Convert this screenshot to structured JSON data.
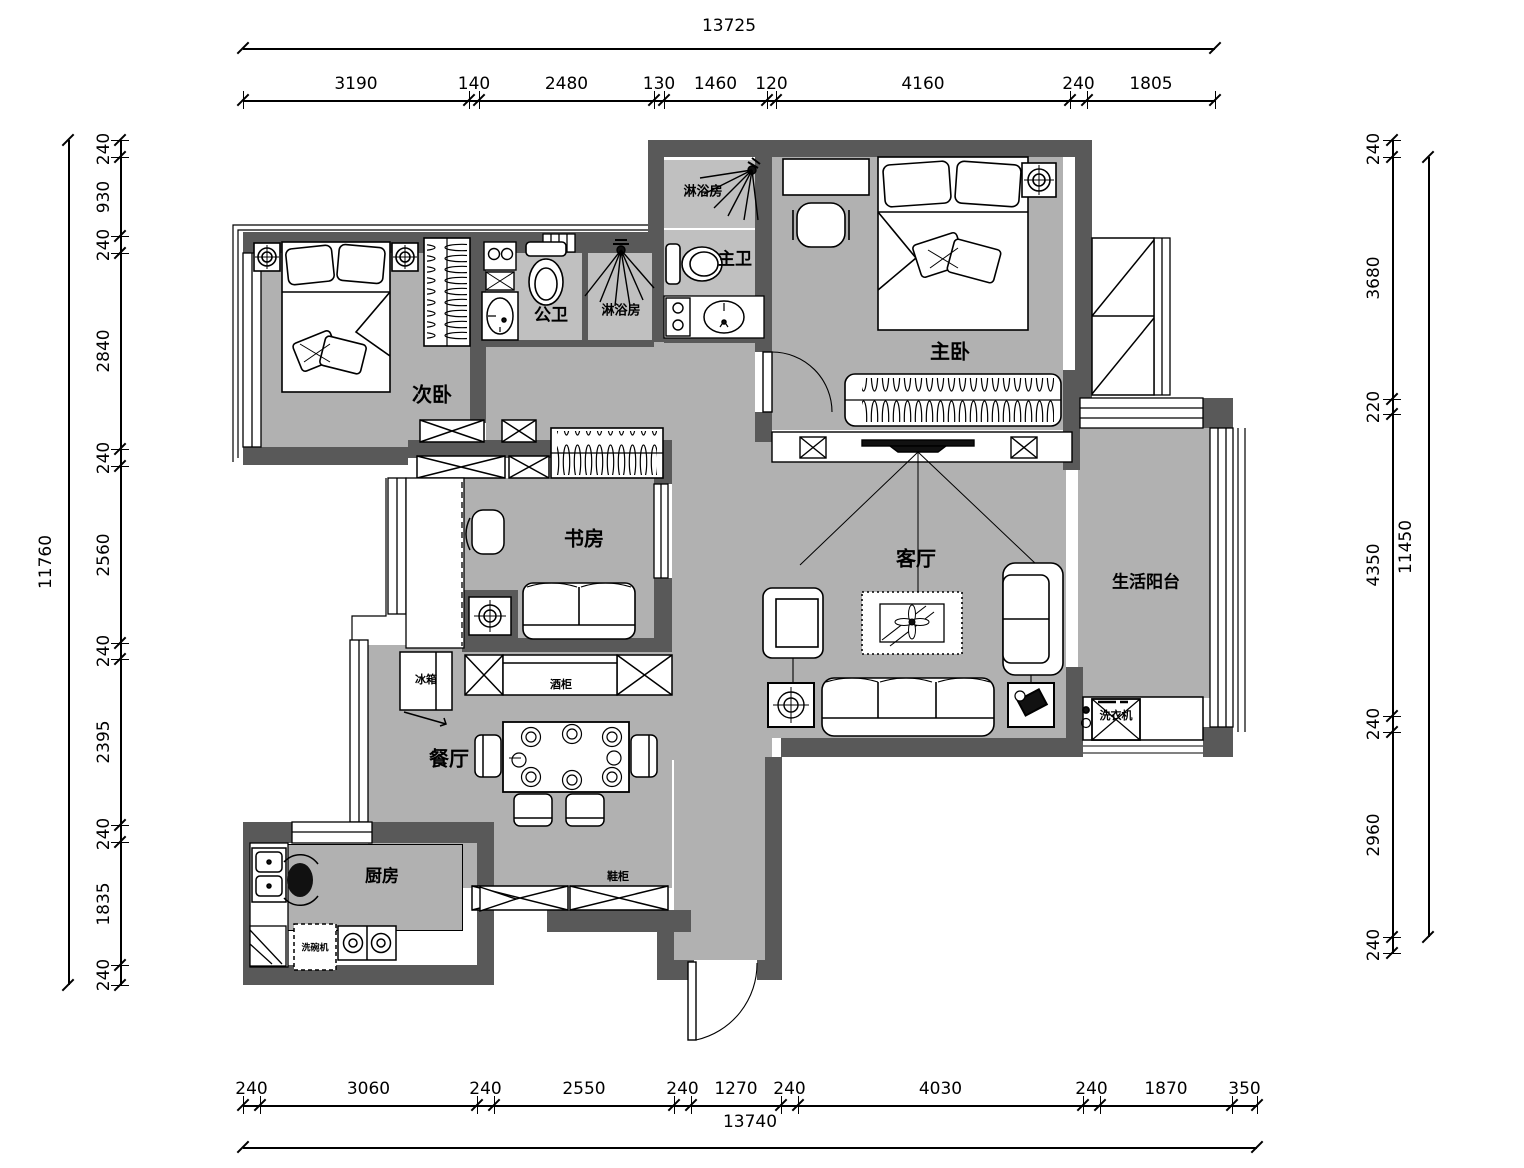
{
  "drawing": {
    "kind": "residential floor plan",
    "units": "mm"
  },
  "rooms": {
    "ciwo": "次卧",
    "gongwei": "公卫",
    "shower_a": "淋浴房",
    "shower_b": "淋浴房",
    "zhuwei": "主卫",
    "zhuwo": "主卧",
    "shufang": "书房",
    "keting": "客厅",
    "yangtai": "生活阳台",
    "canting": "餐厅",
    "chufang": "厨房"
  },
  "furniture": {
    "bingxiang": "冰箱",
    "jiugui": "酒柜",
    "xiegui": "鞋柜",
    "xiyiji": "洗衣机",
    "xiwanji": "洗碗机"
  },
  "dimensions": {
    "top": {
      "total": "13725",
      "segments": [
        "3190",
        "140",
        "2480",
        "130",
        "1460",
        "120",
        "4160",
        "240",
        "1805"
      ]
    },
    "bottom": {
      "total": "13740",
      "segments": [
        "240",
        "3060",
        "240",
        "2550",
        "240",
        "1270",
        "240",
        "4030",
        "240",
        "1870",
        "350"
      ]
    },
    "left": {
      "total": "11760",
      "segments": [
        "240",
        "930",
        "240",
        "2840",
        "240",
        "2560",
        "240",
        "2395",
        "240",
        "1835",
        "240"
      ]
    },
    "right": {
      "total": "11450",
      "segments": [
        "240",
        "3680",
        "220",
        "4350",
        "240",
        "2960",
        "240"
      ]
    }
  },
  "colors": {
    "wall": "#595959",
    "floor": "#b1b1b1",
    "bath_floor": "#c0c0c0",
    "line": "#000000",
    "background": "#ffffff"
  }
}
